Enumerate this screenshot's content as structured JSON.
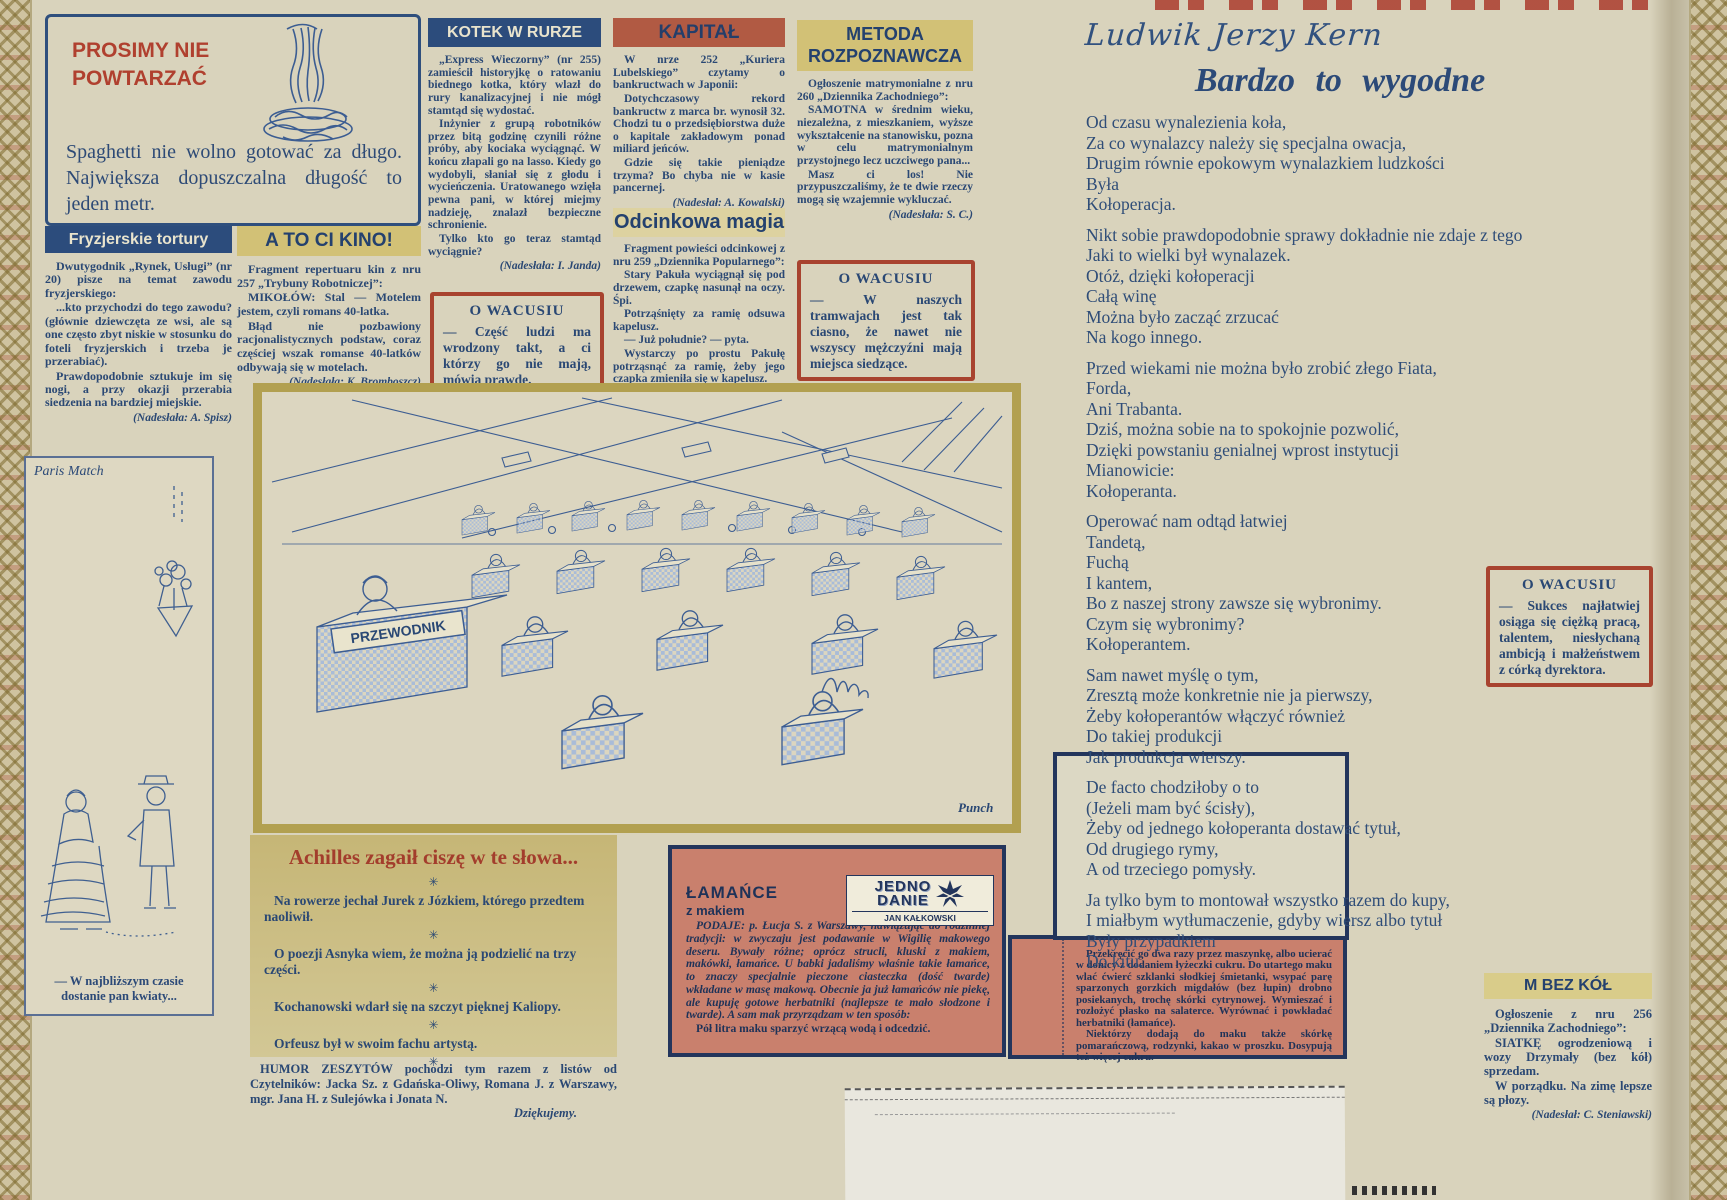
{
  "colors": {
    "navy": "#2c4a78",
    "red": "#a8432f",
    "terracotta": "#b15a43",
    "pink": "#c9806d",
    "khaki": "#c9ba7a",
    "tan": "#d2c176",
    "paper": "#d9d3bc"
  },
  "icons": {
    "asterisk": "✳"
  },
  "prosimy": {
    "title": "PROSIMY NIE\nPOWTARZAĆ",
    "body": "Spaghetti nie wolno gotować za długo. Największa dopuszczalna długość to jeden metr."
  },
  "fryzjerskie": {
    "title": "Fryzjerskie tortury",
    "paragraphs": [
      "Dwutygodnik „Rynek, Usługi” (nr 20) pisze na temat zawodu fryzjerskiego:",
      "...kto przychodzi do tego zawodu? (głównie dziewczęta ze wsi, ale są one często zbyt niskie w stosunku do foteli fryzjerskich i trzeba je przerabiać).",
      "Prawdopodobnie sztukuje im się nogi, a przy okazji przerabia siedzenia na bardziej miejskie."
    ],
    "credit": "(Nadesłała: A. Spisz)"
  },
  "atocikino": {
    "title": "A TO CI KINO!",
    "paragraphs": [
      "Fragment repertuaru kin z nru 257 „Trybuny Robotniczej”:",
      "MIKOŁÓW: Stal — Motelem jestem, czyli romans 40-latka.",
      "Błąd nie pozbawiony racjonalistycznych podstaw, coraz częściej wszak romanse 40-latków odbywają się w motelach."
    ],
    "credit": "(Nadesłała: K. Bromboszcz)"
  },
  "kotek": {
    "title": "KOTEK W RURZE",
    "paragraphs": [
      "„Express Wieczorny” (nr 255) zamieścił historyjkę o ratowaniu biednego kotka, który wlazł do rury kanalizacyjnej i nie mógł stamtąd się wydostać.",
      "Inżynier z grupą robotników przez bitą godzinę czynili różne próby, aby kociaka wyciągnąć. W końcu złapali go na lasso. Kiedy go wydobyli, słaniał się z głodu i wycieńczenia. Uratowanego wzięła pewna pani, w której miejmy nadzieję, znalazł bezpieczne schronienie.",
      "Tylko kto go teraz stamtąd wyciągnie?"
    ],
    "credit": "(Nadesłała: I. Janda)"
  },
  "kapital": {
    "title": "KAPITAŁ",
    "paragraphs": [
      "W nrze 252 „Kuriera Lubelskiego” czytamy o bankructwach w Japonii:",
      "Dotychczasowy rekord bankructw z marca br. wynosił 32. Chodzi tu o przedsiębiorstwa duże o kapitale zakładowym ponad miliard jeńców.",
      "Gdzie się takie pieniądze trzyma? Bo chyba nie w kasie pancernej."
    ],
    "credit": "(Nadesłał: A. Kowalski)"
  },
  "metoda": {
    "title": "METODA\nROZPOZNAWCZA",
    "paragraphs": [
      "Ogłoszenie matrymonialne z nru 260 „Dziennika Zachodniego”:",
      "SAMOTNA w średnim wieku, niezależna, z mieszkaniem, wyższe wykształcenie na stanowisku, pozna w celu matrymonialnym przystojnego lecz uczciwego pana...",
      "Masz ci los! Nie przypuszczaliśmy, że te dwie rzeczy mogą się wzajemnie wykluczać."
    ],
    "credit": "(Nadesłała: S. C.)"
  },
  "odcinkowa": {
    "title": "Odcinkowa magia",
    "paragraphs": [
      "Fragment powieści odcinkowej z nru 259 „Dziennika Popularnego”:",
      "Stary Pakuła wyciągnął się pod drzewem, czapkę nasunął na oczy. Śpi.",
      "Potrząśnięty za ramię odsuwa kapelusz.",
      "— Już południe? — pyta.",
      "Wystarczy po prostu Pakułę potrząsnąć za ramię, żeby jego czapka zmieniła się w kapelusz."
    ],
    "credit": "(Nadesłał: M. Życki)"
  },
  "wacus1": {
    "title": "O WACUSIU",
    "body": "— Część ludzi ma wrodzony takt, a ci którzy go nie mają, mówią prawdę."
  },
  "wacus2": {
    "title": "O WACUSIU",
    "body": "— W naszych tramwajach jest tak ciasno, że nawet nie wszyscy mężczyźni mają miejsca siedzące."
  },
  "wacus3": {
    "title": "O WACUSIU",
    "body": "— Sukces najłatwiej osiąga się ciężką pracą, talentem, niesłychaną ambicją i małżeństwem z córką dyrektora."
  },
  "kern": {
    "author": "Ludwik Jerzy Kern",
    "title": "Bardzo to wygodne",
    "stanzas": [
      "Od czasu wynalezienia koła,\nZa co wynalazcy należy się specjalna owacja,\nDrugim równie epokowym wynalazkiem ludzkości\nByła\nKołoperacja.",
      "Nikt sobie prawdopodobnie sprawy dokładnie nie zdaje z tego\nJaki to wielki był wynalazek.\nOtóż, dzięki kołoperacji\nCałą winę\nMożna było zacząć zrzucać\nNa kogo innego.",
      "Przed wiekami nie można było zrobić złego Fiata,\nForda,\nAni Trabanta.\nDziś, można sobie na to spokojnie pozwolić,\nDzięki powstaniu genialnej wprost instytucji\nMianowicie:\nKołoperanta.",
      "Operować nam odtąd łatwiej\nTandetą,\nFuchą\nI kantem,\nBo z naszej strony zawsze się wybronimy.\nCzym się wybronimy?\nKołoperantem.",
      "Sam nawet myślę o tym,\nZresztą może konkretnie nie ja pierwszy,\nŻeby kołoperantów włączyć również\nDo takiej produkcji\nJak produkcja wierszy.",
      "De facto chodziłoby o to\n(Jeżeli mam być ścisły),\nŻeby od jednego kołoperanta dostawać tytuł,\nOd drugiego rymy,\nA od trzeciego pomysły.",
      "Ja tylko bym to montował wszystko razem do kupy,\nI miałbym wytłumaczenie, gdyby wiersz albo tytuł\nByły przypadkiem\nDo kitu."
    ]
  },
  "paris": {
    "label": "Paris Match",
    "caption": "— W najbliższym czasie dostanie pan kwiaty..."
  },
  "cartoon": {
    "sign": "PRZEWODNIK",
    "credit": "Punch"
  },
  "achilles": {
    "title": "Achilles zagaił ciszę w te słowa...",
    "items": [
      "Na rowerze jechał Jurek z Józkiem, którego przedtem naoliwił.",
      "O poezji Asnyka wiem, że można ją podzielić na trzy części.",
      "Kochanowski wdarł się na szczyt pięknej Kaliopy.",
      "Orfeusz był w swoim fachu artystą."
    ],
    "footer": "HUMOR ZESZYTÓW pochodzi tym razem z listów od Czytelników: Jacka Sz. z Gdańska-Oliwy, Romana J. z Warszawy, mgr. Jana H. z Sulejówka i Jonata N.",
    "footer_sign": "Dziękujemy."
  },
  "lamance": {
    "title": "ŁAMAŃCE",
    "subtitle": "z makiem",
    "logo_line1": "JEDNO",
    "logo_line2": "DANIE",
    "logo_byline": "JAN KAŁKOWSKI",
    "paragraphs": [
      "PODAJE: p. Łucja S. z Warszawy, nawiązując do rodzinnej tradycji: w zwyczaju jest podawanie w Wigilię makowego deseru. Bywały różne; oprócz strucli, kluski z makiem, makówki, łamańce. U babki jadaliśmy właśnie takie łamańce, to znaczy specjalnie pieczone ciasteczka (dość twarde) wkładane w masę makową. Obecnie ja już łamańców nie piekę, ale kupuję gotowe herbatniki (najlepsze te mało słodzone i twarde). A sam mak przyrządzam w ten sposób:",
      "Pół litra maku sparzyć wrzącą wodą i odcedzić."
    ]
  },
  "recipe2": {
    "paragraphs": [
      "Przekręcić go dwa razy przez maszynkę, albo ucierać w donicy z dodaniem łyżeczki cukru. Do utartego maku wlać ćwierć szklanki słodkiej śmietanki, wsypać parę sparzonych gorzkich migdałów (bez łupin) drobno posiekanych, trochę skórki cytrynowej. Wymieszać i rozłożyć płasko na salaterce. Wyrównać i powkładać herbatniki (łamańce).",
      "Niektórzy dodają do maku także skórkę pomarańczową, rodzynki, kakao w proszku. Dosypują też więcej cukru."
    ]
  },
  "mbezkol": {
    "title": "M BEZ KÓŁ",
    "paragraphs": [
      "Ogłoszenie z nru 256 „Dziennika Zachodniego”:",
      "SIATKĘ ogrodzeniową i wozy Drzymały (bez kół) sprzedam.",
      "W porządku. Na zimę lepsze są płozy."
    ],
    "credit": "(Nadesłał: C. Steniawski)"
  }
}
